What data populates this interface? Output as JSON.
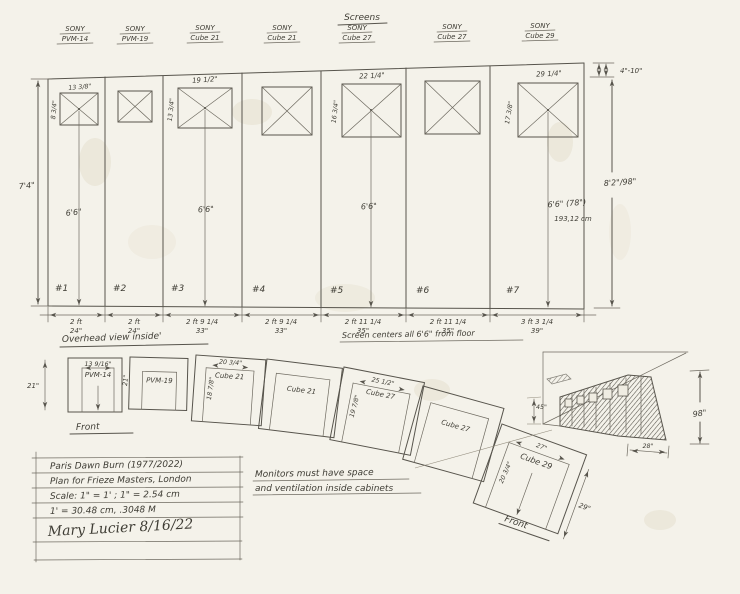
{
  "title": "Screens",
  "elevation": {
    "left_height": "7'4\"",
    "right_height": "8'2\"/98\"",
    "top_gap": "4\"-10\"",
    "floor_note": "Screen centers all 6'6\" from floor",
    "panels": [
      {
        "brand": "SONY",
        "model": "PVM-14",
        "num": "#1",
        "w1": "2 ft",
        "w2": "24\"",
        "sw": "13 3/8\"",
        "sh": "8 3/4\"",
        "c": "6'6\""
      },
      {
        "brand": "SONY",
        "model": "PVM-19",
        "num": "#2",
        "w1": "2 ft",
        "w2": "24\""
      },
      {
        "brand": "SONY",
        "model": "Cube 21",
        "num": "#3",
        "w1": "2 ft 9 1/4",
        "w2": "33\"",
        "sw": "19 1/2\"",
        "sh": "13 3/4\"",
        "c": "6'6\""
      },
      {
        "brand": "SONY",
        "model": "Cube 21",
        "num": "#4",
        "w1": "2 ft 9 1/4",
        "w2": "33\""
      },
      {
        "brand": "SONY",
        "model": "Cube 27",
        "num": "#5",
        "w1": "2 ft 11 1/4",
        "w2": "35\"",
        "sw": "22 1/4\"",
        "sh": "16 3/4\"",
        "c": "6'6\""
      },
      {
        "brand": "SONY",
        "model": "Cube 27",
        "num": "#6",
        "w1": "2 ft 11 1/4",
        "w2": "35\""
      },
      {
        "brand": "SONY",
        "model": "Cube 29",
        "num": "#7",
        "w1": "3 ft 3 1/4",
        "w2": "39\"",
        "sw": "29 1/4\"",
        "sh": "17 3/8\"",
        "c": "6'6\" (78\")",
        "c2": "193,12 cm"
      }
    ]
  },
  "overhead": {
    "title": "Overhead view inside'",
    "front1": "Front",
    "front2": "Front",
    "note1": "Monitors must have space",
    "note2": "and ventilation inside cabinets",
    "cabinets": [
      {
        "label": "PVM-14",
        "top": "13 9/16\"",
        "left": "21\"",
        "side": "21\""
      },
      {
        "label": "PVM-19"
      },
      {
        "label": "Cube 21",
        "top": "20 3/4\"",
        "left": "18 7/8\""
      },
      {
        "label": "Cube 21"
      },
      {
        "label": "Cube 27",
        "top": "25 1/2\"",
        "left": "19 7/8\""
      },
      {
        "label": "Cube 27"
      },
      {
        "label": "Cube 29",
        "top": "27\"",
        "left": "20 3/4\"",
        "right": "29\""
      }
    ]
  },
  "perspective": {
    "gap": "45\"",
    "height": "98\"",
    "depth": "28\""
  },
  "notes_box": {
    "line1": "Paris Dawn Burn (1977/2022)",
    "line2": "Plan for Frieze Masters, London",
    "line3": "Scale: 1\" = 1' ; 1\" = 2.54 cm",
    "line4": "1' = 30.48 cm, .3048 M",
    "signature": "Mary Lucier 8/16/22"
  }
}
